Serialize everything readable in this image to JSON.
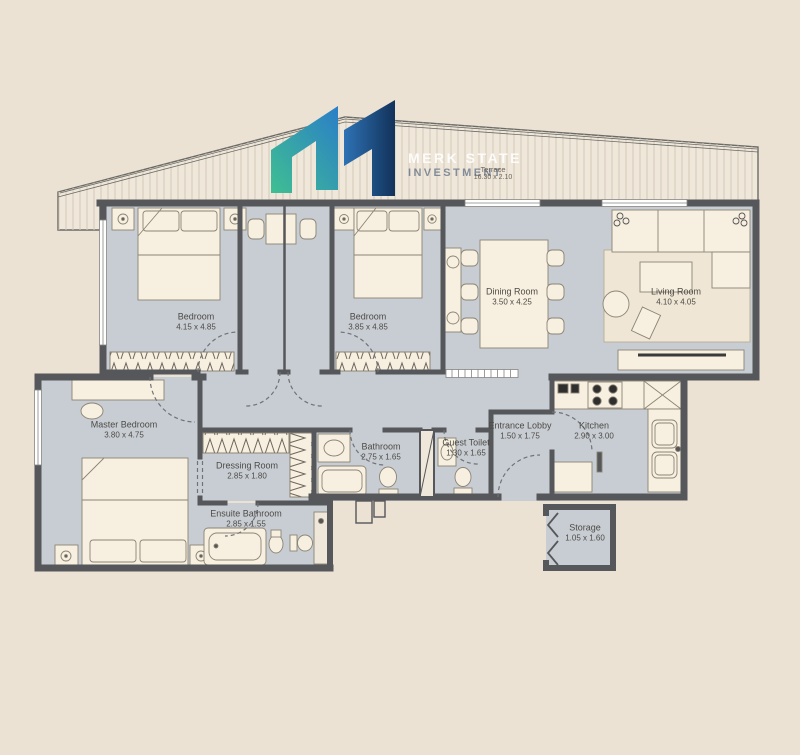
{
  "watermark": {
    "line1": "MERK STATE",
    "line2": "INVESTMENT"
  },
  "rooms": [
    {
      "id": "terrace",
      "name": "Terrace",
      "dims": "16.30 x 2.10"
    },
    {
      "id": "bedroom-1",
      "name": "Bedroom",
      "dims": "4.15 x 4.85"
    },
    {
      "id": "bedroom-2",
      "name": "Bedroom",
      "dims": "3.85 x 4.85"
    },
    {
      "id": "dining-room",
      "name": "Dining Room",
      "dims": "3.50 x 4.25"
    },
    {
      "id": "living-room",
      "name": "Living Room",
      "dims": "4.10 x 4.05"
    },
    {
      "id": "master-bedroom",
      "name": "Master Bedroom",
      "dims": "3.80 x 4.75"
    },
    {
      "id": "dressing-room",
      "name": "Dressing Room",
      "dims": "2.85 x 1.80"
    },
    {
      "id": "ensuite-bathroom",
      "name": "Ensuite Bathroom",
      "dims": "2.85 x 1.55"
    },
    {
      "id": "bathroom",
      "name": "Bathroom",
      "dims": "2.75 x 1.65"
    },
    {
      "id": "guest-toilet",
      "name": "Guest Toilet",
      "dims": "1.30 x 1.65"
    },
    {
      "id": "entrance-lobby",
      "name": "Entrance Lobby",
      "dims": "1.50 x 1.75"
    },
    {
      "id": "kitchen",
      "name": "Kitchen",
      "dims": "2.90 x 3.00"
    },
    {
      "id": "storage",
      "name": "Storage",
      "dims": "1.05 x 1.60"
    }
  ],
  "colors": {
    "background": "#EBE2D4",
    "floor": "#C8CDD3",
    "wall": "#55575A",
    "furniture": "#F7EFDF",
    "logo_teal": "#3FBF92",
    "logo_blue": "#2B7EC7",
    "logo_navy": "#12325A"
  }
}
